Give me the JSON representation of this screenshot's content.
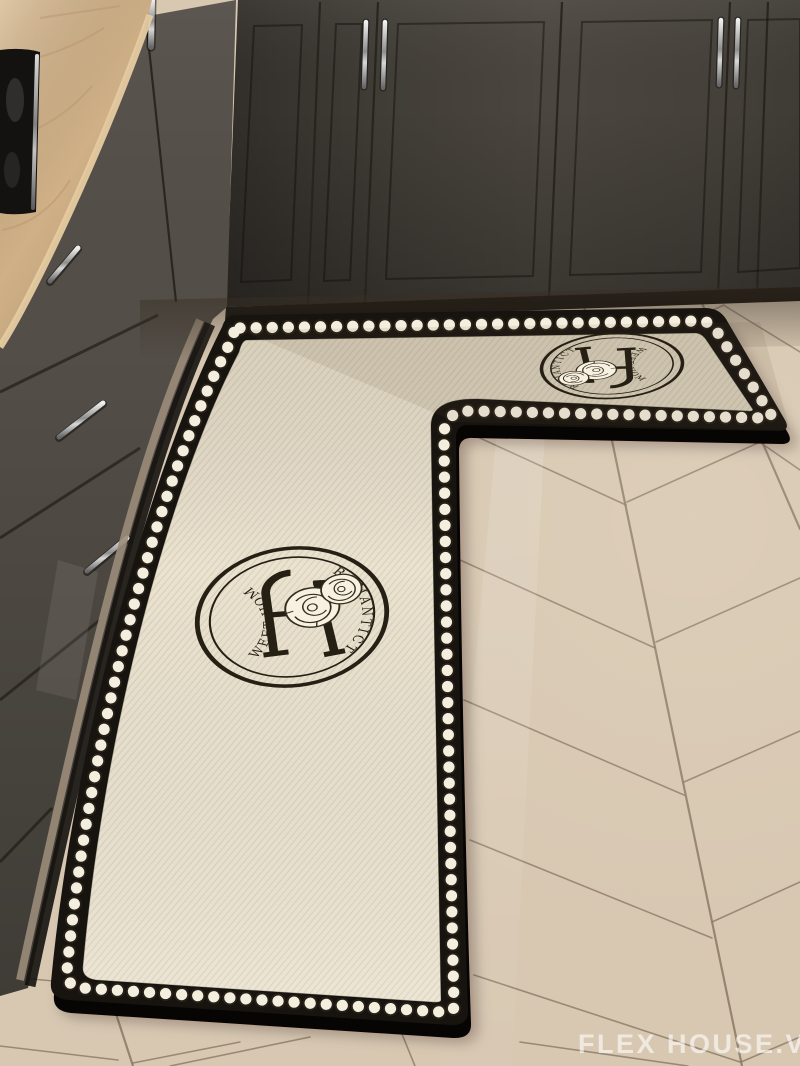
{
  "watermark": {
    "text": "FLEX HOUSE.VN",
    "color": "#ffffff"
  },
  "mat": {
    "emblem": {
      "arc_text_left": "SWEET HOME",
      "arc_text_right": "ROMANTICT"
    },
    "colors": {
      "border": "#17140f",
      "field": "#ebe3d0",
      "pearls": "#f4eedf",
      "ink": "#261f14"
    }
  },
  "kitchen": {
    "colors": {
      "floor": "#d8c8b2",
      "floor_seam": "#8b7864",
      "upper_cabinets": "#4b463f",
      "lower_cabinets": "#534e47",
      "countertop": "#d4b489"
    }
  }
}
